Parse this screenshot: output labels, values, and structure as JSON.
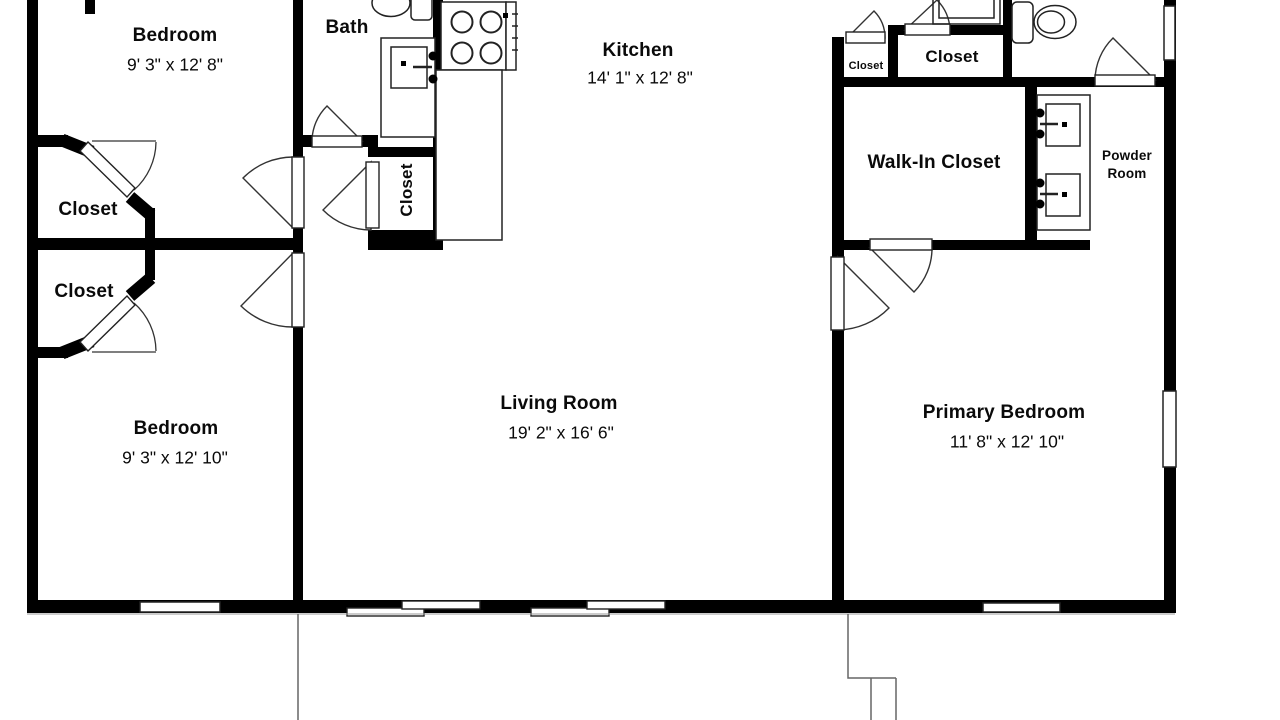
{
  "colors": {
    "wall": "#000000",
    "background": "#ffffff",
    "line": "#333333"
  },
  "rooms": {
    "bedroom_top": {
      "name": "Bedroom",
      "dims": "9' 3\" x 12' 8\""
    },
    "bath": {
      "name": "Bath"
    },
    "kitchen": {
      "name": "Kitchen",
      "dims": "14' 1\" x 12' 8\""
    },
    "closet_small": {
      "name": "Closet"
    },
    "closet_top_right": {
      "name": "Closet"
    },
    "walk_in_closet": {
      "name": "Walk-In Closet"
    },
    "powder_room": {
      "name_line1": "Powder",
      "name_line2": "Room"
    },
    "closet_left_upper": {
      "name": "Closet"
    },
    "closet_left_lower": {
      "name": "Closet"
    },
    "closet_hall": {
      "name": "Closet"
    },
    "bedroom_bottom": {
      "name": "Bedroom",
      "dims": "9' 3\" x 12' 10\""
    },
    "living_room": {
      "name": "Living Room",
      "dims": "19' 2\" x 16' 6\""
    },
    "primary_bedroom": {
      "name": "Primary Bedroom",
      "dims": "11' 8\" x 12' 10\""
    }
  }
}
